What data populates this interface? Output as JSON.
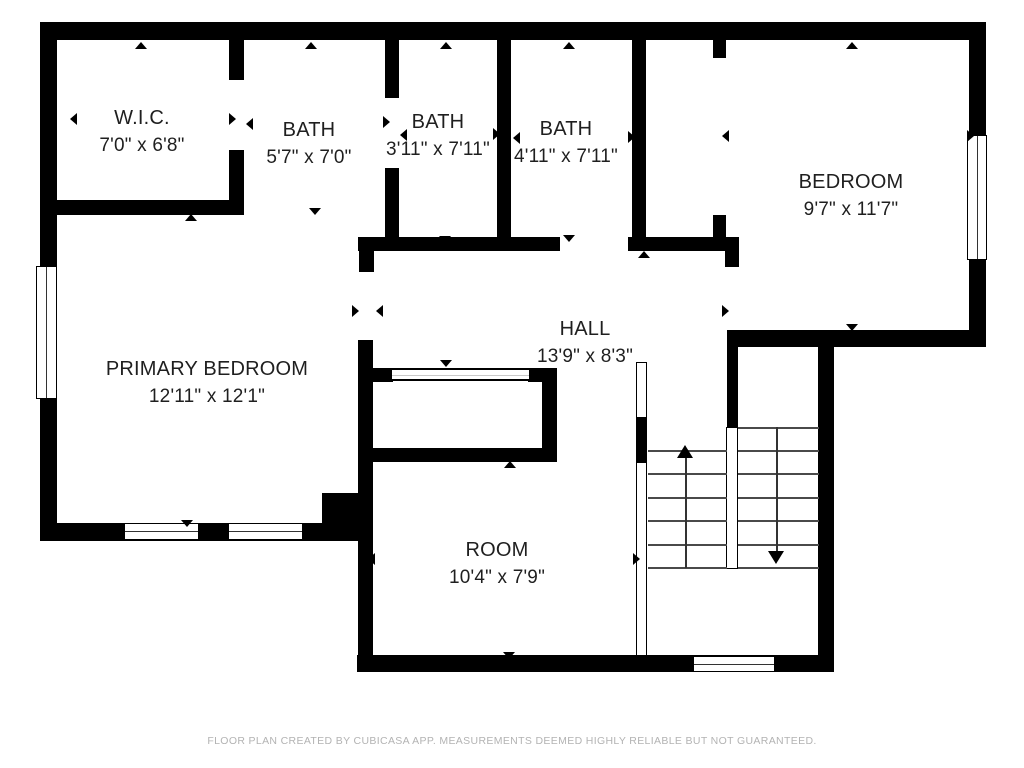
{
  "title": "Floor Plan",
  "colors": {
    "wall": "#000000",
    "background": "#ffffff",
    "label_text": "#1f1f1f",
    "footer_text": "#b3b3b3",
    "stair_tread": "#4a4a4a"
  },
  "rooms": [
    {
      "id": "wic",
      "name": "W.I.C.",
      "dimensions": "7'0\" x 6'8\""
    },
    {
      "id": "bath1",
      "name": "BATH",
      "dimensions": "5'7\" x 7'0\""
    },
    {
      "id": "bath2",
      "name": "BATH",
      "dimensions": "3'11\" x 7'11\""
    },
    {
      "id": "bath3",
      "name": "BATH",
      "dimensions": "4'11\" x 7'11\""
    },
    {
      "id": "bedroom",
      "name": "BEDROOM",
      "dimensions": "9'7\" x 11'7\""
    },
    {
      "id": "primary",
      "name": "PRIMARY BEDROOM",
      "dimensions": "12'11\" x 12'1\""
    },
    {
      "id": "hall",
      "name": "HALL",
      "dimensions": "13'9\" x 8'3\""
    },
    {
      "id": "room",
      "name": "ROOM",
      "dimensions": "10'4\" x 7'9\""
    }
  ],
  "stairs": {
    "up_flight": "up-arrow",
    "down_flight": "down-arrow"
  },
  "footer": {
    "disclaimer": "FLOOR PLAN CREATED BY CUBICASA APP. MEASUREMENTS DEEMED HIGHLY RELIABLE BUT NOT GUARANTEED."
  }
}
